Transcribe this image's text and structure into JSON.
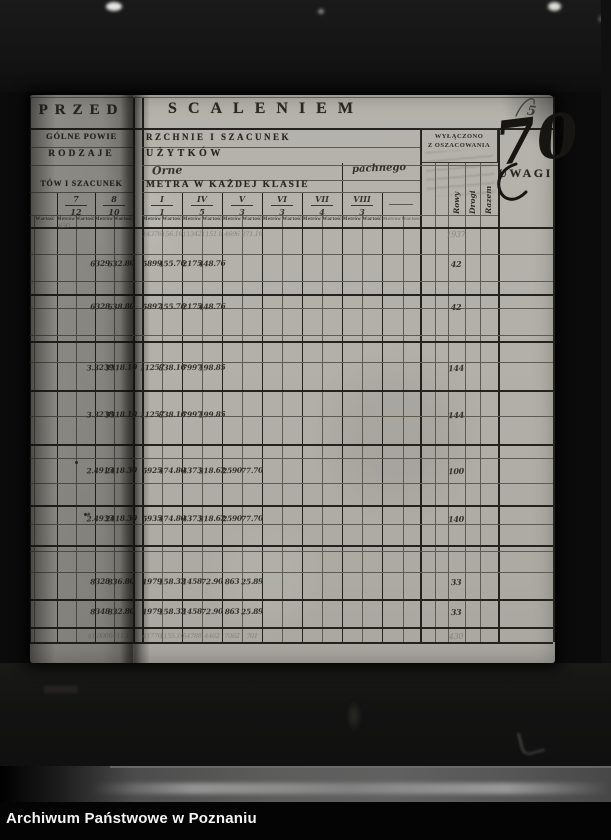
{
  "archive_caption": "Archiwum Państwowe w Poznaniu",
  "page_number": "5",
  "corner_mark": "70",
  "labels": {
    "metrow": "Metrów",
    "wartosc": "Wartość"
  },
  "left_page": {
    "title": "PRZED",
    "line2": "GÓLNE POWIE",
    "line3": "RODZAJE",
    "line4": "TÓW I SZACUNEK",
    "class_columns": [
      {
        "numerator": "7",
        "denominator": "12"
      },
      {
        "numerator": "8",
        "denominator": "10"
      }
    ],
    "partial_subheader": "Wartość",
    "pencil_note": "630"
  },
  "right_page": {
    "title": "SCALENIEM",
    "line2": "RZCHNIE I SZACUNEK",
    "line3": "UŻYTKÓW",
    "handwritten_left": "Orne",
    "handwritten_right": "pachnego",
    "line5": "METRA W KAŻDEJ KLASIE",
    "class_columns": [
      {
        "numerator": "I",
        "denominator": "1"
      },
      {
        "numerator": "IV",
        "denominator": "5"
      },
      {
        "numerator": "V",
        "denominator": "3"
      },
      {
        "numerator": "VI",
        "denominator": "3"
      },
      {
        "numerator": "VII",
        "denominator": "4"
      },
      {
        "numerator": "VIII",
        "denominator": "3"
      }
    ],
    "excluded_stamp": {
      "line1": "WYŁĄCZONO",
      "line2": "Z OSZACOWANIA"
    },
    "excluded_columns": [
      "Rowy",
      "Drogi",
      "Razem"
    ],
    "uwagi": "UWAGI"
  },
  "table_rows": [
    {
      "style": "pencil",
      "left": [
        "",
        ""
      ],
      "cells": [
        "14376",
        "156.16",
        "11342",
        "1151.6",
        "4696",
        "271.16"
      ],
      "rowy": "1937"
    },
    {
      "style": "ink",
      "left": [
        "6329",
        "632.80"
      ],
      "cells": [
        "5899",
        "455.76",
        "2175",
        "448.76",
        "",
        ""
      ],
      "rowy": "42"
    },
    {
      "style": "ink",
      "left": [
        "6328",
        "638.80"
      ],
      "cells": [
        "5897",
        "455.76",
        "2175",
        "448.76",
        "",
        ""
      ],
      "rowy": "42"
    },
    {
      "style": "ink",
      "left": [
        "3.3239",
        "3318.10"
      ],
      "cells": [
        "11257",
        "838.16",
        "7997",
        "198.85",
        "",
        ""
      ],
      "rowy": "144"
    },
    {
      "style": "ink",
      "left": [
        "3.3238",
        "3318.10"
      ],
      "cells": [
        "11257",
        "838.16",
        "7997",
        "199.85",
        "",
        ""
      ],
      "rowy": "144"
    },
    {
      "style": "ink",
      "left": [
        "2.4913",
        "2418.30"
      ],
      "cells": [
        "5925",
        "474.80",
        "4373",
        "318.62",
        "2590",
        "77.70"
      ],
      "rowy": "100"
    },
    {
      "style": "ink",
      "left": [
        "2.4933",
        "2418.30"
      ],
      "cells": [
        "5935",
        "474.80",
        "4373",
        "318.62",
        "2590",
        "77.70"
      ],
      "rowy": "140",
      "mark": "✳"
    },
    {
      "style": "ink",
      "left": [
        "8328",
        "836.80"
      ],
      "cells": [
        "1979",
        "158.32",
        "1458",
        "72.90",
        "863",
        "25.89"
      ],
      "rowy": "33"
    },
    {
      "style": "ink",
      "left": [
        "8348",
        "832.80"
      ],
      "cells": [
        "1979",
        "158.32",
        "1458",
        "72.90",
        "863",
        "25.89"
      ],
      "rowy": "33"
    },
    {
      "style": "pencil",
      "left": [
        "41.0000",
        "411.1"
      ],
      "cells": [
        "41776",
        "1155.16",
        "54788",
        "4462",
        "7062",
        "701"
      ],
      "rowy": "430"
    }
  ]
}
